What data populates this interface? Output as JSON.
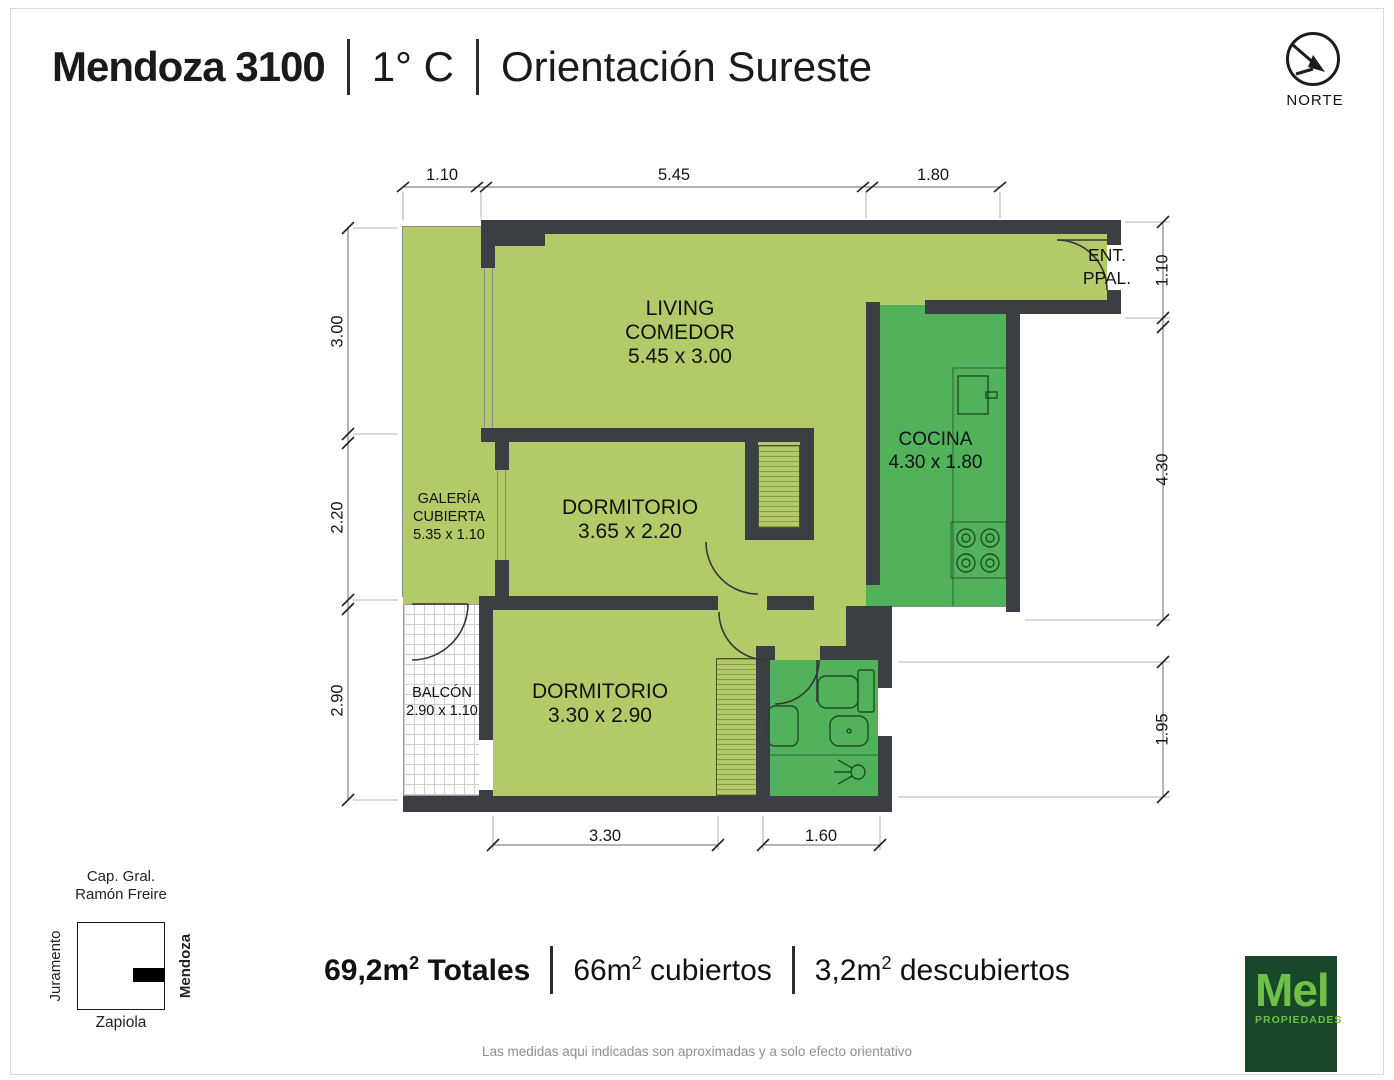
{
  "header": {
    "address": "Mendoza 3100",
    "unit": "1° C",
    "orientation": "Orientación Sureste"
  },
  "north": {
    "label": "NORTE"
  },
  "rooms": {
    "living": {
      "name": "LIVING",
      "name2": "COMEDOR",
      "size": "5.45 x 3.00"
    },
    "cocina": {
      "name": "COCINA",
      "size": "4.30 x 1.80"
    },
    "galeria": {
      "name": "GALERÍA",
      "name2": "CUBIERTA",
      "size": "5.35 x 1.10"
    },
    "dorm1": {
      "name": "DORMITORIO",
      "size": "3.65 x 2.20"
    },
    "dorm2": {
      "name": "DORMITORIO",
      "size": "3.30 x 2.90"
    },
    "balcon": {
      "name": "BALCÓN",
      "size": "2.90 x 1.10"
    },
    "entrada": {
      "line1": "ENT.",
      "line2": "PPAL."
    }
  },
  "dimensions": {
    "top": [
      "1.10",
      "5.45",
      "1.80"
    ],
    "left": [
      "3.00",
      "2.20",
      "2.90"
    ],
    "right": [
      "1.10",
      "4.30",
      "1.95"
    ],
    "bottom": [
      "3.30",
      "1.60"
    ]
  },
  "map": {
    "top1": "Cap. Gral.",
    "top2": "Ramón Freire",
    "left": "Juramento",
    "right": "Mendoza",
    "bottom": "Zapiola"
  },
  "summary": {
    "items": [
      {
        "pre": "69,2m",
        "sup": "2",
        "post": " Totales"
      },
      {
        "pre": "66m",
        "sup": "2",
        "post": " cubiertos"
      },
      {
        "pre": "3,2m",
        "sup": "2",
        "post": " descubiertos"
      }
    ]
  },
  "disclaimer": "Las medidas aqui indicadas son aproximadas y a solo efecto orientativo",
  "logo": {
    "name": "Mel",
    "sub": "PROPIEDADES"
  },
  "colors": {
    "floor_light": "#b3ca69",
    "floor_dark": "#52b25c",
    "wall": "#3b3e42",
    "logo_bg": "#17482a",
    "logo_green": "#70bf46"
  }
}
